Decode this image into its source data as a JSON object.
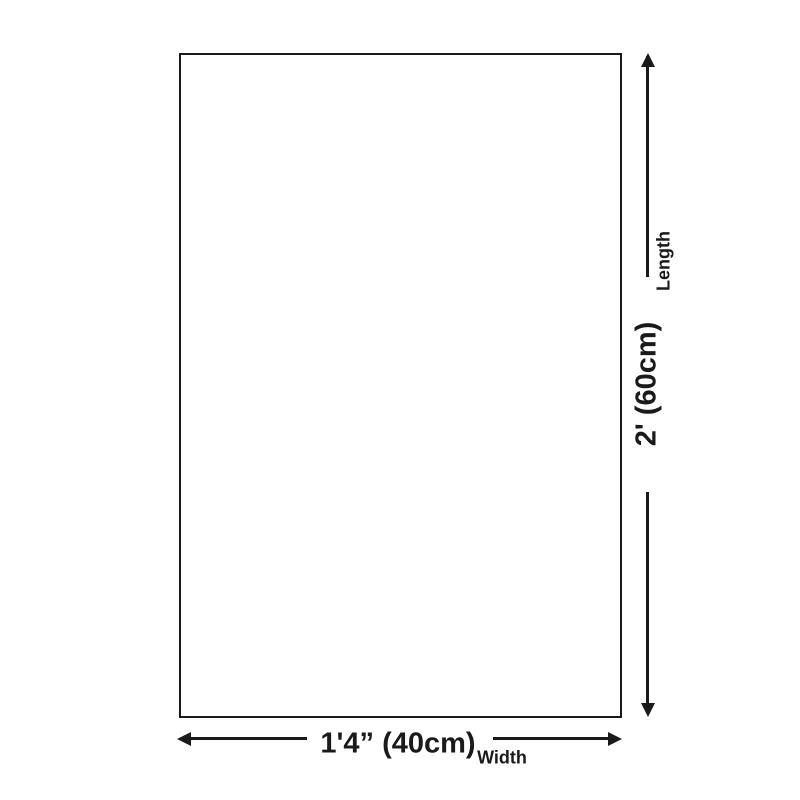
{
  "page": {
    "background": "#ffffff"
  },
  "diagram": {
    "type": "product-dimension-diagram",
    "line_color": "#1a1a1a",
    "shape": "rectangle",
    "length_dimension": {
      "label": "Length",
      "value": "2' (60cm)"
    },
    "width_dimension": {
      "label": "Width",
      "value": "1'4” (40cm)"
    }
  }
}
